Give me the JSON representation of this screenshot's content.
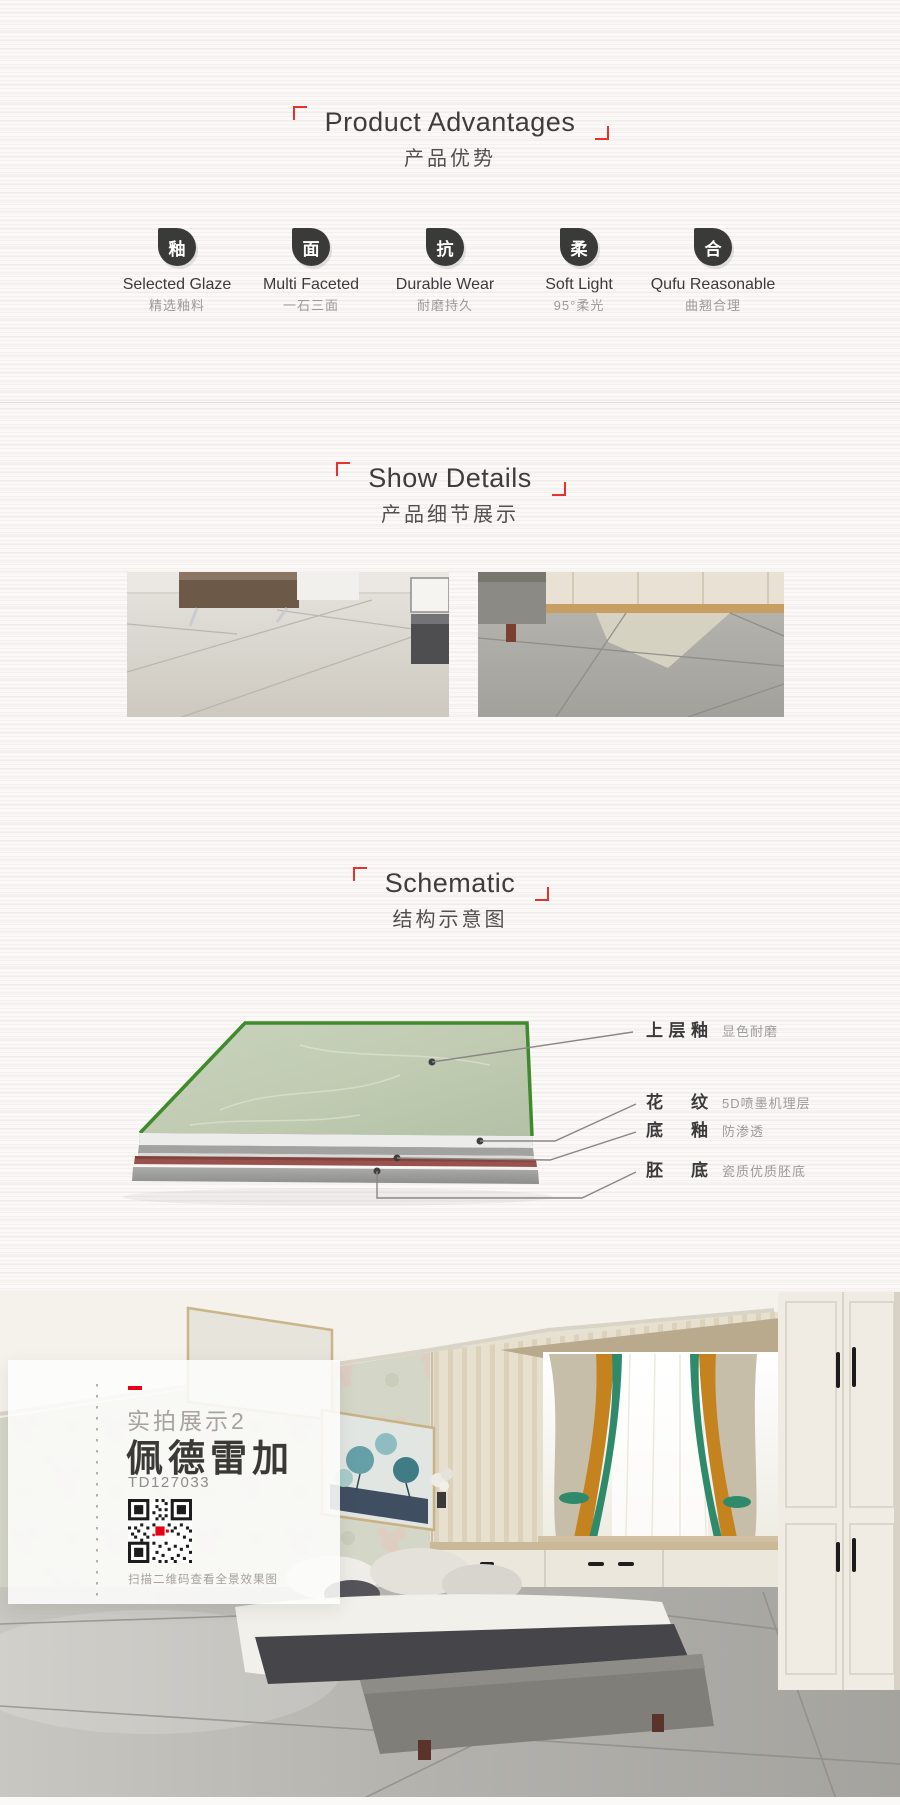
{
  "colors": {
    "accent_red": "#e8302e",
    "brand_red": "#e60012",
    "icon_bg": "#3a3a38",
    "tile_edge_green": "#3e8a2c",
    "tile_surface_green": "#c2cdb4",
    "tile_red_layer": "#99524d"
  },
  "sections": {
    "advantages": {
      "title_en": "Product Advantages",
      "title_zh": "产品优势",
      "features": [
        {
          "glyph": "釉",
          "en": "Selected Glaze",
          "zh": "精选釉料"
        },
        {
          "glyph": "面",
          "en": "Multi Faceted",
          "zh": "一石三面"
        },
        {
          "glyph": "抗",
          "en": "Durable Wear",
          "zh": "耐磨持久"
        },
        {
          "glyph": "柔",
          "en": "Soft Light",
          "zh": "95°柔光"
        },
        {
          "glyph": "合",
          "en": "Qufu Reasonable",
          "zh": "曲翘合理"
        }
      ]
    },
    "details": {
      "title_en": "Show Details",
      "title_zh": "产品细节展示"
    },
    "schematic": {
      "title_en": "Schematic",
      "title_zh": "结构示意图",
      "layers": [
        {
          "name": "上层釉",
          "desc": "显色耐磨"
        },
        {
          "name": "花纹",
          "desc": "5D喷墨机理层"
        },
        {
          "name": "底釉",
          "desc": "防渗透"
        },
        {
          "name": "胚底",
          "desc": "瓷质优质胚底"
        }
      ]
    },
    "showcase": {
      "tag": "实拍展示2",
      "product_name": "佩德雷加",
      "model": "TD127033",
      "qr_caption": "扫描二维码查看全景效果图"
    }
  }
}
